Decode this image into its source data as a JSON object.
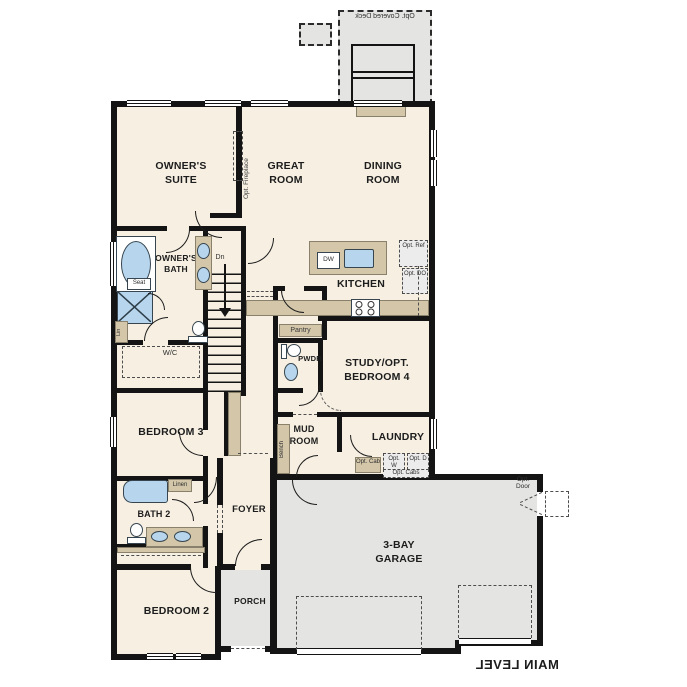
{
  "labels": {
    "deck": "Opt. Covered Deck",
    "owners_suite": "OWNER'S SUITE",
    "great_room": "GREAT ROOM",
    "dining_room": "DINING ROOM",
    "opt_fireplace": "Opt. Fireplace",
    "owners_bath": "OWNER'S BATH",
    "seat": "Seat",
    "lin": "Lin",
    "dn": "Dn",
    "kitchen": "KITCHEN",
    "dw": "DW",
    "opt_ref": "Opt. Ref",
    "opt_do": "Opt. DO",
    "pantry": "Pantry",
    "pwdr": "PWDR",
    "study": "STUDY/OPT. BEDROOM 4",
    "wc": "W/C",
    "bedroom3": "BEDROOM 3",
    "bench": "Bench",
    "mud_room": "MUD ROOM",
    "laundry": "LAUNDRY",
    "opt_cab": "Opt. Cab",
    "opt_w": "Opt. W",
    "opt_d": "Opt. D",
    "opt_cabs": "Opt. Cabs",
    "linen": "Linen",
    "bath2": "BATH 2",
    "foyer": "FOYER",
    "bedroom2": "BEDROOM 2",
    "porch": "PORCH",
    "garage": "3-BAY GARAGE",
    "opt_door": "Opt. Door",
    "main_level": "MAIN LEVEL"
  },
  "colors": {
    "floor": "#f6efe2",
    "wall": "#141414",
    "cabinet": "#d3c6a9",
    "fixture": "#b7d6ee",
    "exterior": "#e4e4e2",
    "page": "#ffffff"
  }
}
